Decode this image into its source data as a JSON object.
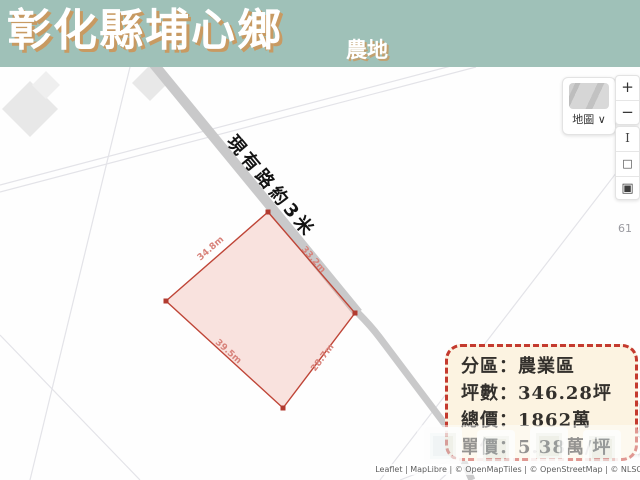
{
  "header": {
    "title": "彰化縣埔心鄉",
    "subtitle": "農地"
  },
  "map": {
    "road_label": "現有路約3米",
    "road_number_label": "61",
    "parcel": {
      "edge_labels": [
        "34.8m",
        "33.2m",
        "39.5m",
        "28.7m"
      ]
    },
    "attribution": "Leaflet | MapLibre | © OpenMapTiles | © OpenStreetMap | © NLSC"
  },
  "map_controls": {
    "basemap_label": "地圖",
    "basemap_caret": "∨",
    "zoom_in": "+",
    "zoom_out": "−",
    "tool_measure": "I",
    "tool_rect": "□",
    "tool_fill": "▣",
    "locate_arrow": "▶"
  },
  "info_box": {
    "zoning": "分區：農業區",
    "area": "坪數：346.28坪",
    "total_price": "總價：1862萬",
    "unit_price": "單價：5.38萬/坪"
  },
  "colors": {
    "header_bg": "#9fc1b8",
    "title_shadow": "#c89a62",
    "road_gray": "#c9c9ca",
    "parcel_fill": "#f7ddd6",
    "parcel_stroke": "#bf4537",
    "edge_label": "#d8827a",
    "info_border": "#c43a2e",
    "info_bg": "#fcf3e1"
  }
}
